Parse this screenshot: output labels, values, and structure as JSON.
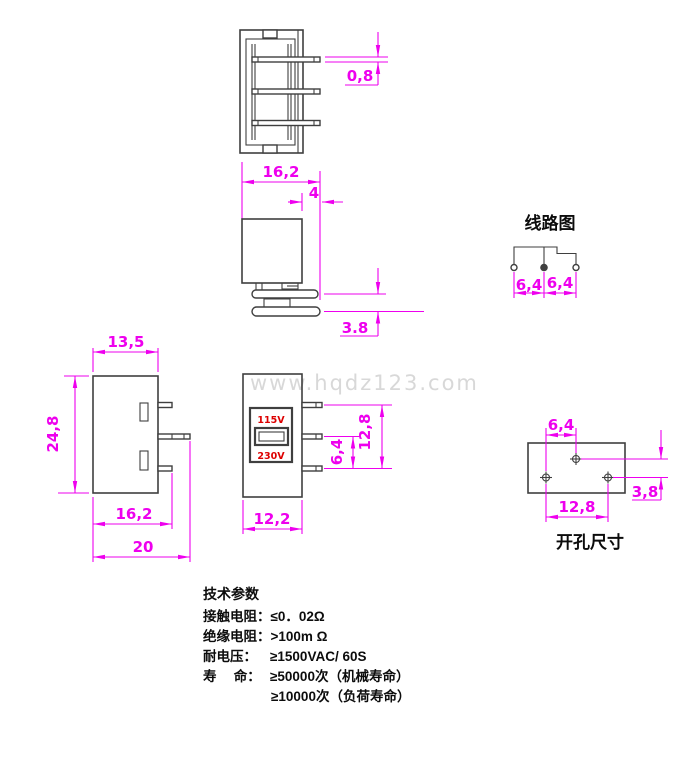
{
  "watermark": "www.hqdz123.com",
  "colors": {
    "c-dim": "#ee00ee",
    "c-line": "#3f3f3f",
    "c-red": "#dd0000",
    "c-wm": "#d8d8d8"
  },
  "top_view": {
    "dim_pin_thickness": "0,8",
    "dim_depth_total": "16,2",
    "dim_pin_protrusion": "4"
  },
  "side_view": {
    "dim_pin_gap": "3.8"
  },
  "circuit_diagram": {
    "title": "线路图",
    "dim_left": "6,4",
    "dim_right": "6,4"
  },
  "front_view": {
    "dim_width": "13,5",
    "dim_height": "24,8",
    "dim_to_short_pins": "16,2",
    "dim_to_long_pin": "20"
  },
  "face_view": {
    "label_115v": "115V",
    "label_230v": "230V",
    "dim_pin_pitch": "6,4",
    "dim_pin_span": "12,8",
    "dim_width": "12,2"
  },
  "cutout_view": {
    "title": "开孔尺寸",
    "dim_hole_offset": "6,4",
    "dim_hole_span": "12,8",
    "dim_vertical": "3,8"
  },
  "specs": {
    "title": "技术参数",
    "rows": [
      {
        "label": "接触电阻：",
        "value": "≤0．02Ω"
      },
      {
        "label": "绝缘电阻：",
        "value": ">100m Ω"
      },
      {
        "label": "耐电压：",
        "value": "≥1500VAC/ 60S"
      },
      {
        "label": "寿　 命：",
        "value": "≥50000次（机械寿命）"
      },
      {
        "label": "",
        "value": "≥10000次（负荷寿命）"
      }
    ]
  }
}
